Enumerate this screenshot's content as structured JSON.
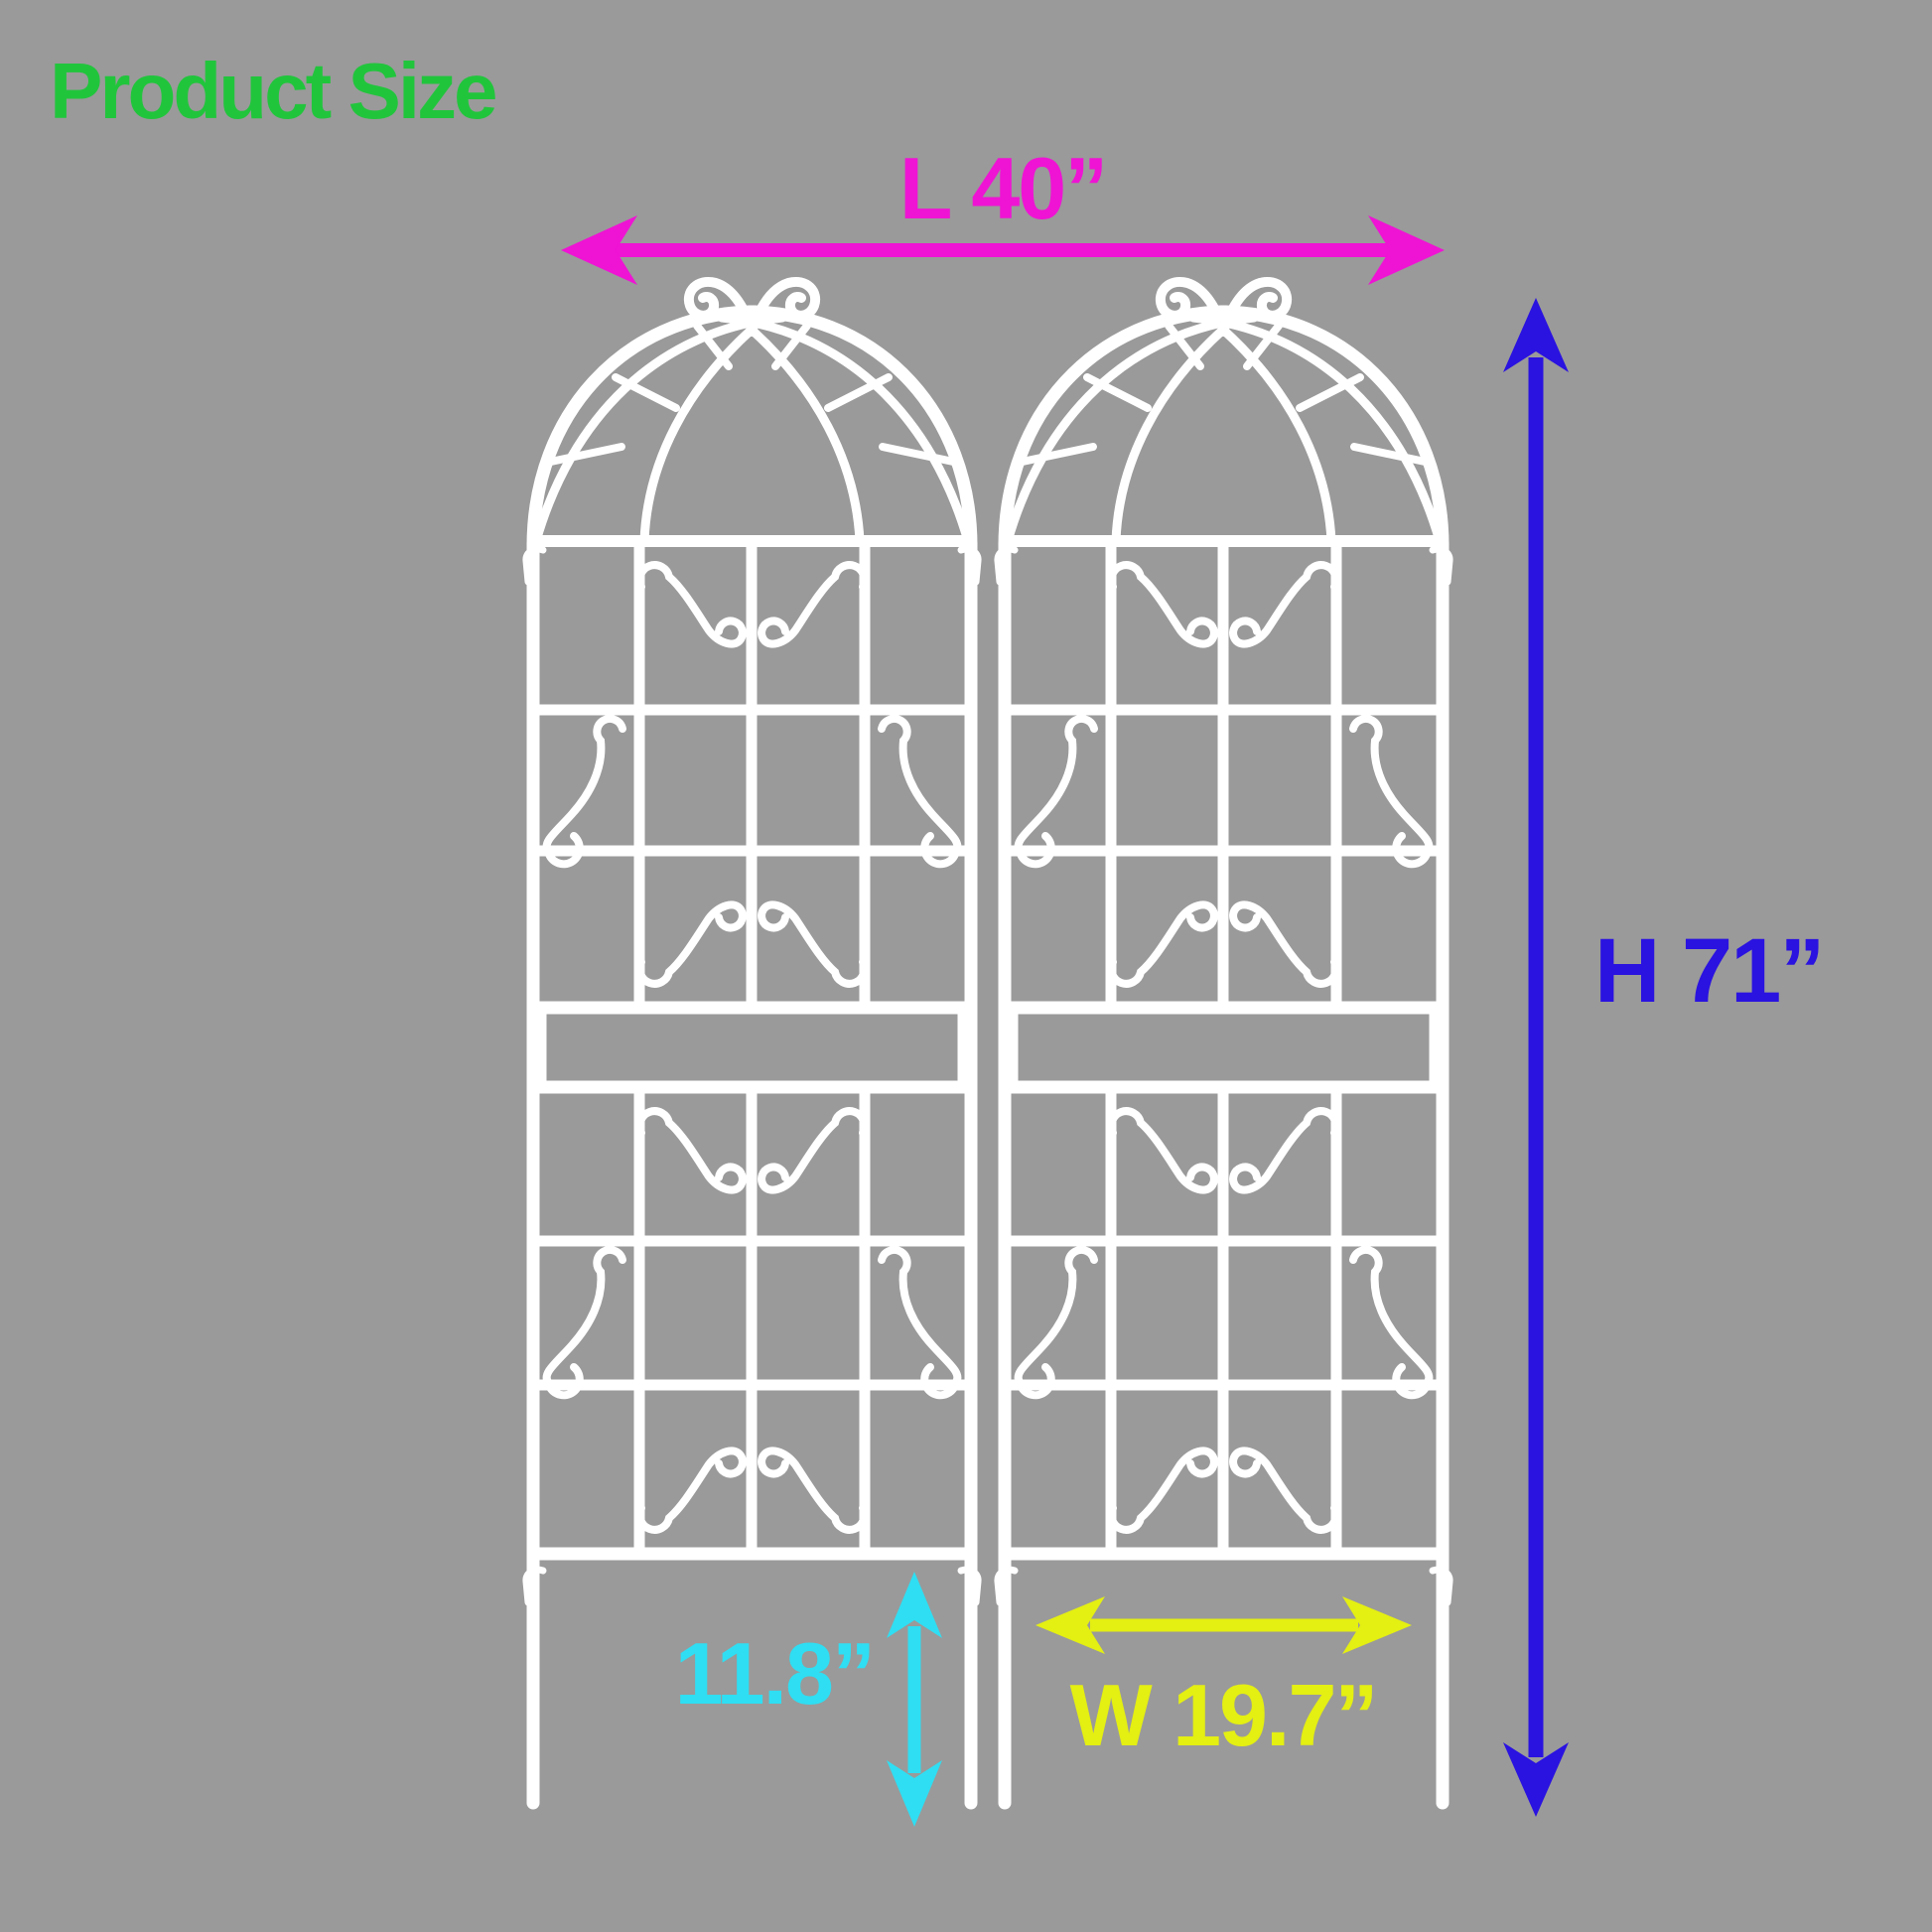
{
  "page": {
    "background_color": "#9a9a9a"
  },
  "title": {
    "text": "Product Size",
    "color": "#21c53c"
  },
  "dimensions": {
    "length": {
      "label": "L 40”",
      "color": "#ef13d4"
    },
    "height": {
      "label": "H 71”",
      "color": "#2a12e0"
    },
    "leg_height": {
      "label": "11.8”",
      "color": "#2fdef2"
    },
    "panel_width": {
      "label": "W 19.7”",
      "color": "#e4ef12"
    }
  },
  "graphic": {
    "type": "garden-trellis-size-diagram",
    "panel_count": 2,
    "panels": [
      "trellis-panel-left",
      "trellis-panel-right"
    ],
    "trellis_color": "#ffffff"
  }
}
